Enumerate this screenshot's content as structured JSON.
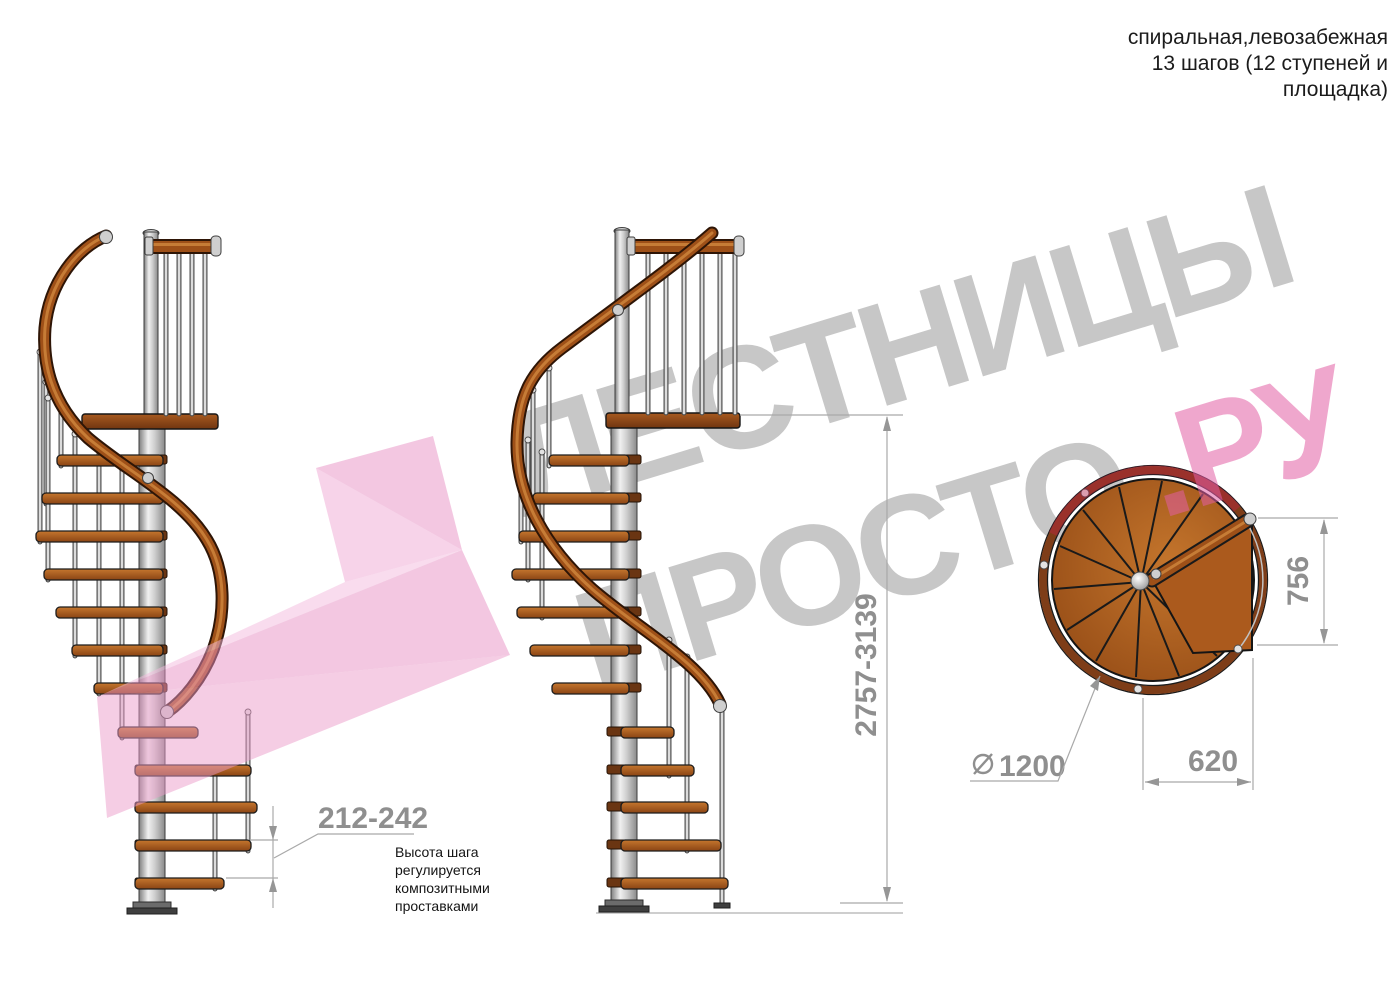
{
  "header": {
    "line1": "спиральная,левозабежная",
    "line2": "13 шагов (12 ступеней и",
    "line3": "площадка)"
  },
  "dimensions": {
    "step_pitch": "212-242",
    "total_height": "2757-3139",
    "landing_height": "756",
    "landing_width": "620",
    "diameter": "1200"
  },
  "note": {
    "line1": "Высота шага",
    "line2": "регулируется",
    "line3": "композитными",
    "line4": "проставками"
  },
  "watermark": {
    "title": "ЛЕСТНИЦЫ",
    "subtitle": "ПРОСТО",
    "suffix": ".РУ"
  },
  "colors": {
    "wood": "#9e5018",
    "steel": "#d9d9d9",
    "dim_text": "#8f8f8f",
    "watermark_gray": "#c7c7c7",
    "watermark_pink": "#e25fa4",
    "logo_pink": "#ef9fce"
  }
}
